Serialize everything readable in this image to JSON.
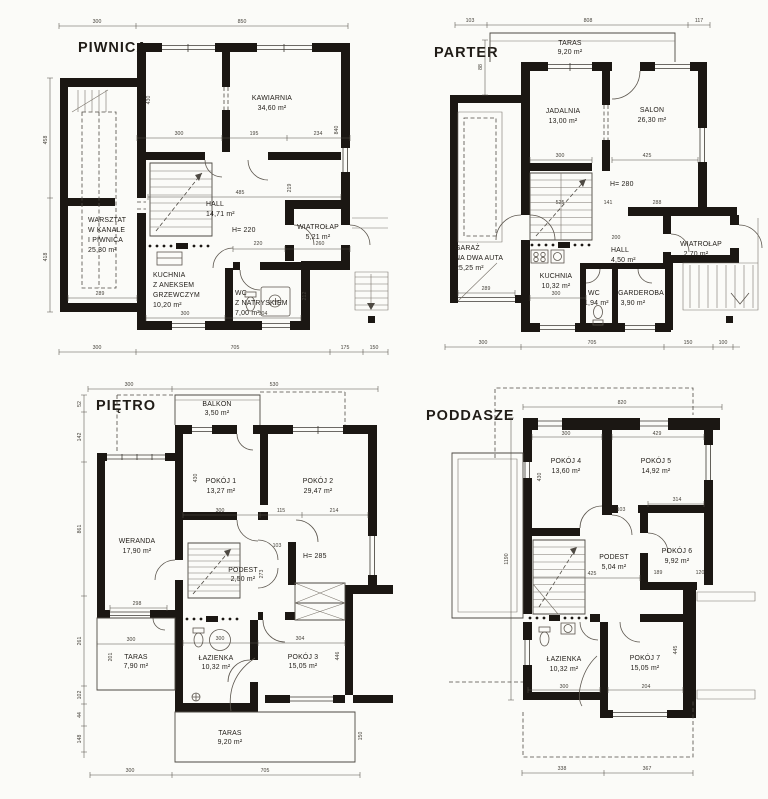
{
  "floors": {
    "piwnica": {
      "title": "PIWNICA",
      "h": "H= 220",
      "rooms": {
        "kawiarnia": [
          "KAWIARNIA",
          "34,60 m²"
        ],
        "warsztat": [
          "WARSZTAT",
          "W KANALE",
          "I PIWNICA",
          "25,30 m²"
        ],
        "hall": [
          "HALL",
          "14,71 m²"
        ],
        "wiatrolap": [
          "WIATROŁAP",
          "5,21 m²"
        ],
        "kuchnia": [
          "KUCHNIA",
          "Z ANEKSEM",
          "GRZEWCZYM",
          "10,20 m²"
        ],
        "wc": [
          "WC",
          "Z NATRYSKIEM",
          "7,00 m²"
        ]
      },
      "d": [
        "300",
        "850",
        "300",
        "195",
        "234",
        "485",
        "220",
        "260",
        "300",
        "304",
        "289",
        "300",
        "705",
        "175",
        "150",
        "430",
        "840",
        "458",
        "418",
        "219",
        "212"
      ]
    },
    "parter": {
      "title": "PARTER",
      "h": "H= 280",
      "rooms": {
        "taras": [
          "TARAS",
          "9,20 m²"
        ],
        "jadalnia": [
          "JADALNIA",
          "13,00 m²"
        ],
        "salon": [
          "SALON",
          "26,30 m²"
        ],
        "garaz": [
          "GARAŻ",
          "NA DWA AUTA",
          "25,25 m²"
        ],
        "kuchnia": [
          "KUCHNIA",
          "10,32 m²"
        ],
        "hall": [
          "HALL",
          "4,50 m²"
        ],
        "wc": [
          "WC",
          "1,94 m²"
        ],
        "garderoba": [
          "GARDEROBA",
          "3,90 m²"
        ],
        "wiatrolap": [
          "WIATROŁAP",
          "2,70 m²"
        ]
      },
      "d": [
        "103",
        "808",
        "117",
        "300",
        "425",
        "525",
        "141",
        "288",
        "200",
        "300",
        "289",
        "300",
        "705",
        "150",
        "100",
        "88"
      ]
    },
    "pietro": {
      "title": "PIĘTRO",
      "h": "H= 285",
      "rooms": {
        "balkon": [
          "BALKON",
          "3,50 m²"
        ],
        "pokoj1": [
          "POKÓJ 1",
          "13,27 m²"
        ],
        "pokoj2": [
          "POKÓJ 2",
          "29,47 m²"
        ],
        "weranda": [
          "WERANDA",
          "17,90 m²"
        ],
        "podest": [
          "PODEST",
          "2,50 m²"
        ],
        "taras1": [
          "TARAS",
          "7,90 m²"
        ],
        "lazienka": [
          "ŁAZIENKA",
          "10,32 m²"
        ],
        "pokoj3": [
          "POKÓJ 3",
          "15,05 m²"
        ],
        "taras2": [
          "TARAS",
          "9,20 m²"
        ]
      },
      "d": [
        "300",
        "530",
        "300",
        "115",
        "214",
        "103",
        "298",
        "300",
        "300",
        "304",
        "300",
        "705",
        "52",
        "142",
        "861",
        "261",
        "102",
        "44",
        "148",
        "430",
        "273",
        "201",
        "446",
        "150"
      ]
    },
    "poddasze": {
      "title": "PODDASZE",
      "rooms": {
        "pokoj4": [
          "POKÓJ 4",
          "13,60 m²"
        ],
        "pokoj5": [
          "POKÓJ 5",
          "14,92 m²"
        ],
        "podest": [
          "PODEST",
          "5,04 m²"
        ],
        "pokoj6": [
          "POKÓJ 6",
          "9,92 m²"
        ],
        "lazienka": [
          "ŁAZIENKA",
          "10,32 m²"
        ],
        "pokoj7": [
          "POKÓJ 7",
          "15,05 m²"
        ]
      },
      "d": [
        "820",
        "300",
        "429",
        "103",
        "314",
        "425",
        "189",
        "120",
        "300",
        "204",
        "338",
        "367",
        "1190",
        "430",
        "445"
      ]
    }
  }
}
